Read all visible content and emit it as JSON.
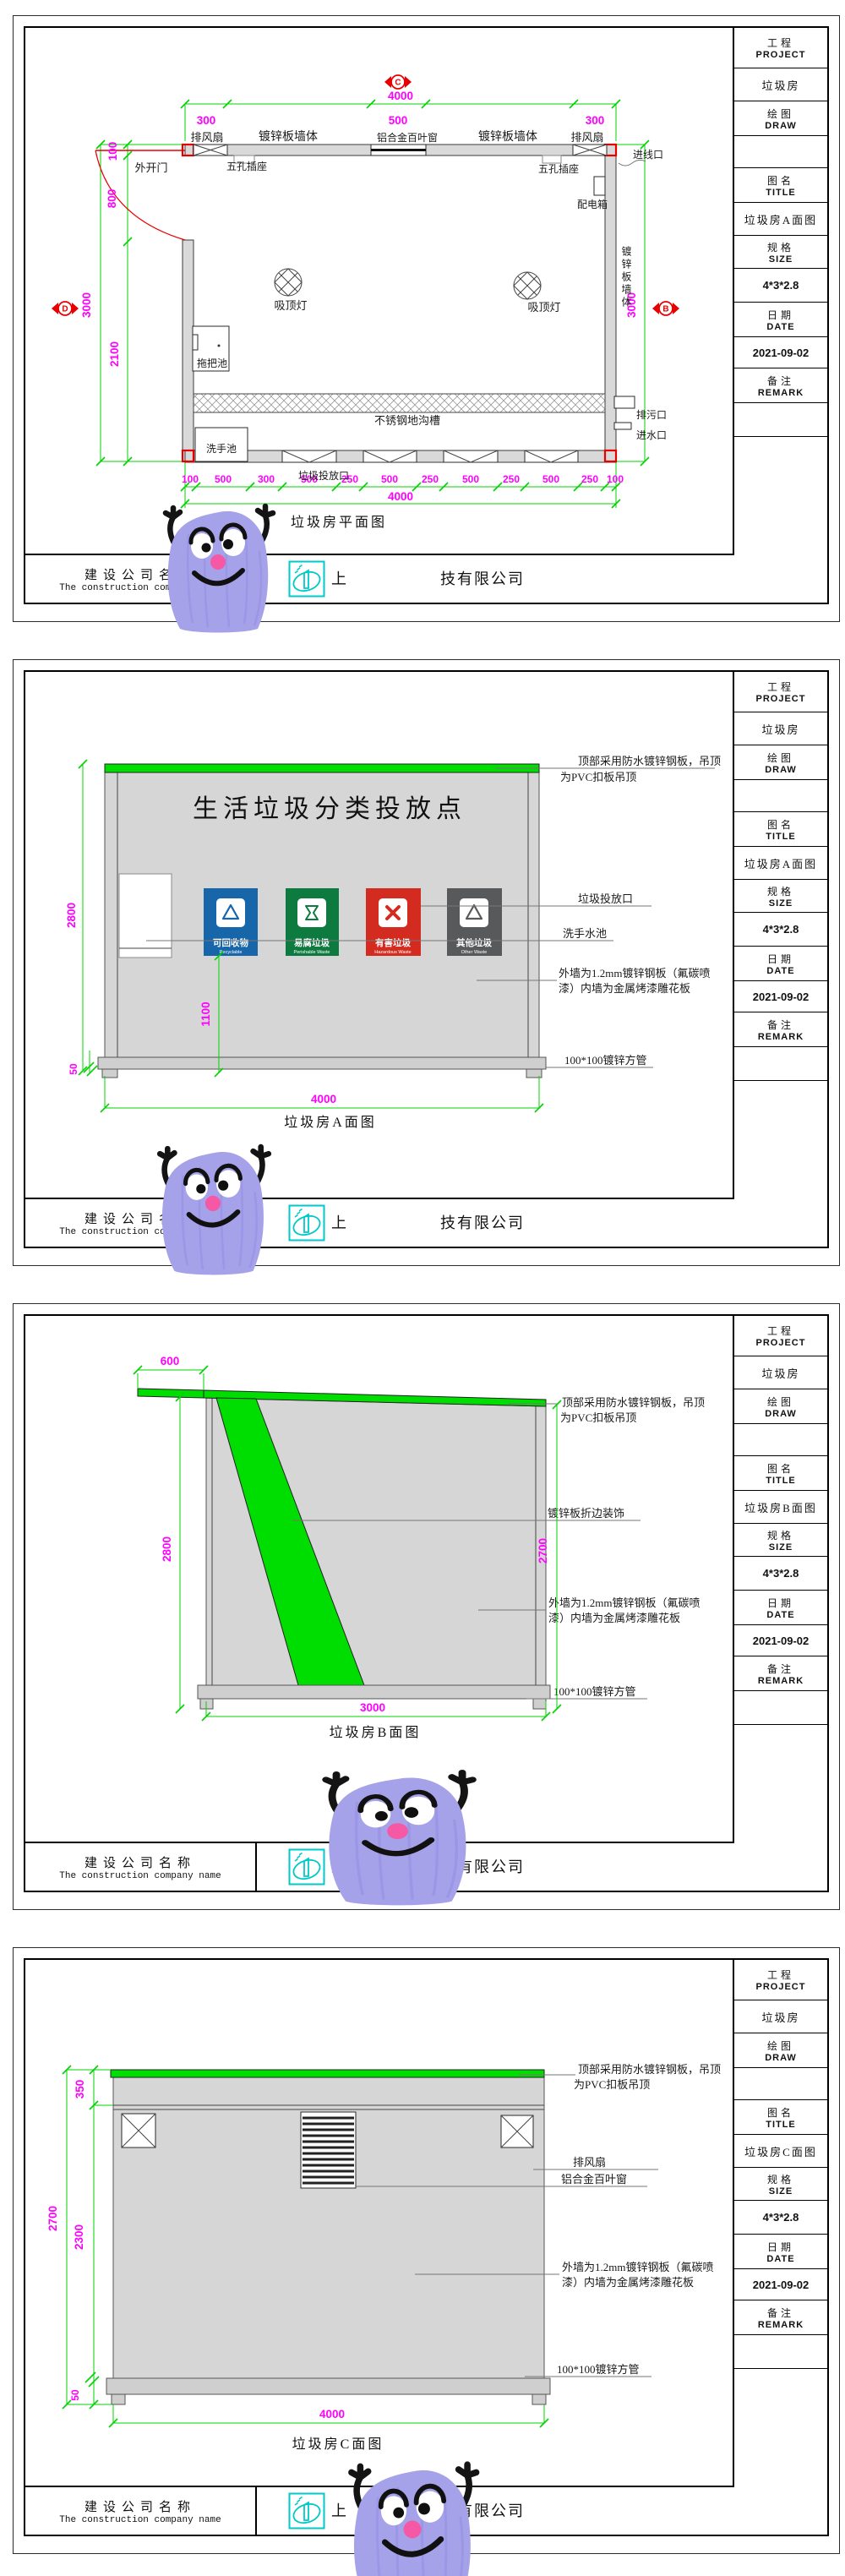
{
  "colors": {
    "dim_green": "#00d400",
    "dim_magenta": "#ff00ff",
    "marker_red": "#e80000",
    "roof_green": "#00dd00",
    "wall_gray": "#d9d9d9",
    "logo_cyan": "#00c9c9",
    "mascot_purple": "#a6a2e9"
  },
  "tb": {
    "project_cn": "工程",
    "project_en": "PROJECT",
    "draw_cn": "绘图",
    "draw_en": "DRAW",
    "title_cn": "图名",
    "title_en": "TITLE",
    "size_cn": "规格",
    "size_en": "SIZE",
    "date_cn": "日期",
    "date_en": "DATE",
    "remark_cn": "备注",
    "remark_en": "REMARK"
  },
  "tbv": {
    "project": "垃圾房",
    "size": "4*3*2.8",
    "date": "2021-09-02"
  },
  "footer": {
    "company_cn": "建设公司名称",
    "company_en": "The construction company name",
    "logo": "company-logo",
    "name_left": "上",
    "name_right": "技有限公司"
  },
  "sheets": {
    "s1": {
      "tb_title": "垃圾房A面图",
      "caption": "垃圾房平面图",
      "markers": {
        "c": "C",
        "d": "D",
        "b": "B"
      },
      "labels": {
        "fan_left": "排风扇",
        "fan_right": "排风扇",
        "wall_left": "镀锌板墙体",
        "wall_right": "镀锌板墙体",
        "louver": "铝合金百叶窗",
        "socket_left": "五孔插座",
        "socket_right": "五孔插座",
        "inlet": "进线口",
        "door": "外开门",
        "dist_box": "配电箱",
        "lamp_left": "吸顶灯",
        "lamp_right": "吸顶灯",
        "mop": "拖把池",
        "trench": "不锈钢地沟槽",
        "sink": "洗手池",
        "chute": "垃圾投放口",
        "drain": "排污口",
        "water": "进水口",
        "wall_vertical": "镀锌板墙体"
      },
      "dims": {
        "top_total": "4000",
        "top": [
          "300",
          "500",
          "300"
        ],
        "left": [
          "100",
          "800",
          "2100"
        ],
        "left_total": "3000",
        "right_total": "3000",
        "bottom": [
          "100",
          "500",
          "300",
          "500",
          "250",
          "500",
          "250",
          "500",
          "250",
          "500",
          "250",
          "100"
        ],
        "bottom_total": "4000"
      }
    },
    "s2": {
      "tb_title": "垃圾房A面图",
      "caption": "垃圾房A面图",
      "sign": "生活垃圾分类投放点",
      "notes": {
        "roof1": "顶部采用防水镀锌钢板，吊顶",
        "roof2": "为PVC扣板吊顶",
        "chute": "垃圾投放口",
        "sink": "洗手水池",
        "wall1": "外墙为1.2mm镀锌钢板（氟碳喷",
        "wall2": "漆）内墙为金属烤漆雕花板",
        "pipe": "100*100镀锌方管"
      },
      "bins": [
        {
          "label": "可回收物",
          "en": "Recyclable",
          "color": "#1766aa",
          "icon": "recycle-icon"
        },
        {
          "label": "易腐垃圾",
          "en": "Perishable Waste",
          "color": "#0d7a3f",
          "icon": "food-waste-icon"
        },
        {
          "label": "有害垃圾",
          "en": "Hazardous Waste",
          "color": "#d42b20",
          "icon": "hazardous-icon"
        },
        {
          "label": "其他垃圾",
          "en": "Other Waste",
          "color": "#58595b",
          "icon": "other-waste-icon"
        }
      ],
      "dims": {
        "height": "2800",
        "bin_height": "1100",
        "base": "50",
        "width_total": "4000"
      }
    },
    "s3": {
      "tb_title": "垃圾房B面图",
      "caption": "垃圾房B面图",
      "notes": {
        "roof1": "顶部采用防水镀锌钢板，吊顶",
        "roof2": "为PVC扣板吊顶",
        "trim": "镀锌板折边装饰",
        "wall1": "外墙为1.2mm镀锌钢板（氟碳喷",
        "wall2": "漆）内墙为金属烤漆雕花板",
        "pipe": "100*100镀锌方管"
      },
      "dims": {
        "overhang": "600",
        "height": "2800",
        "right_height": "2700",
        "width_total": "3000"
      }
    },
    "s4": {
      "tb_title": "垃圾房C面图",
      "caption": "垃圾房C面图",
      "notes": {
        "roof1": "顶部采用防水镀锌钢板，吊顶",
        "roof2": "为PVC扣板吊顶",
        "fan": "排风扇",
        "louver": "铝合金百叶窗",
        "wall1": "外墙为1.2mm镀锌钢板（氟碳喷",
        "wall2": "漆）内墙为金属烤漆雕花板",
        "pipe": "100*100镀锌方管"
      },
      "dims": {
        "top": "350",
        "height_total": "2700",
        "lower": "2300",
        "base": "50",
        "width_total": "4000"
      }
    }
  }
}
